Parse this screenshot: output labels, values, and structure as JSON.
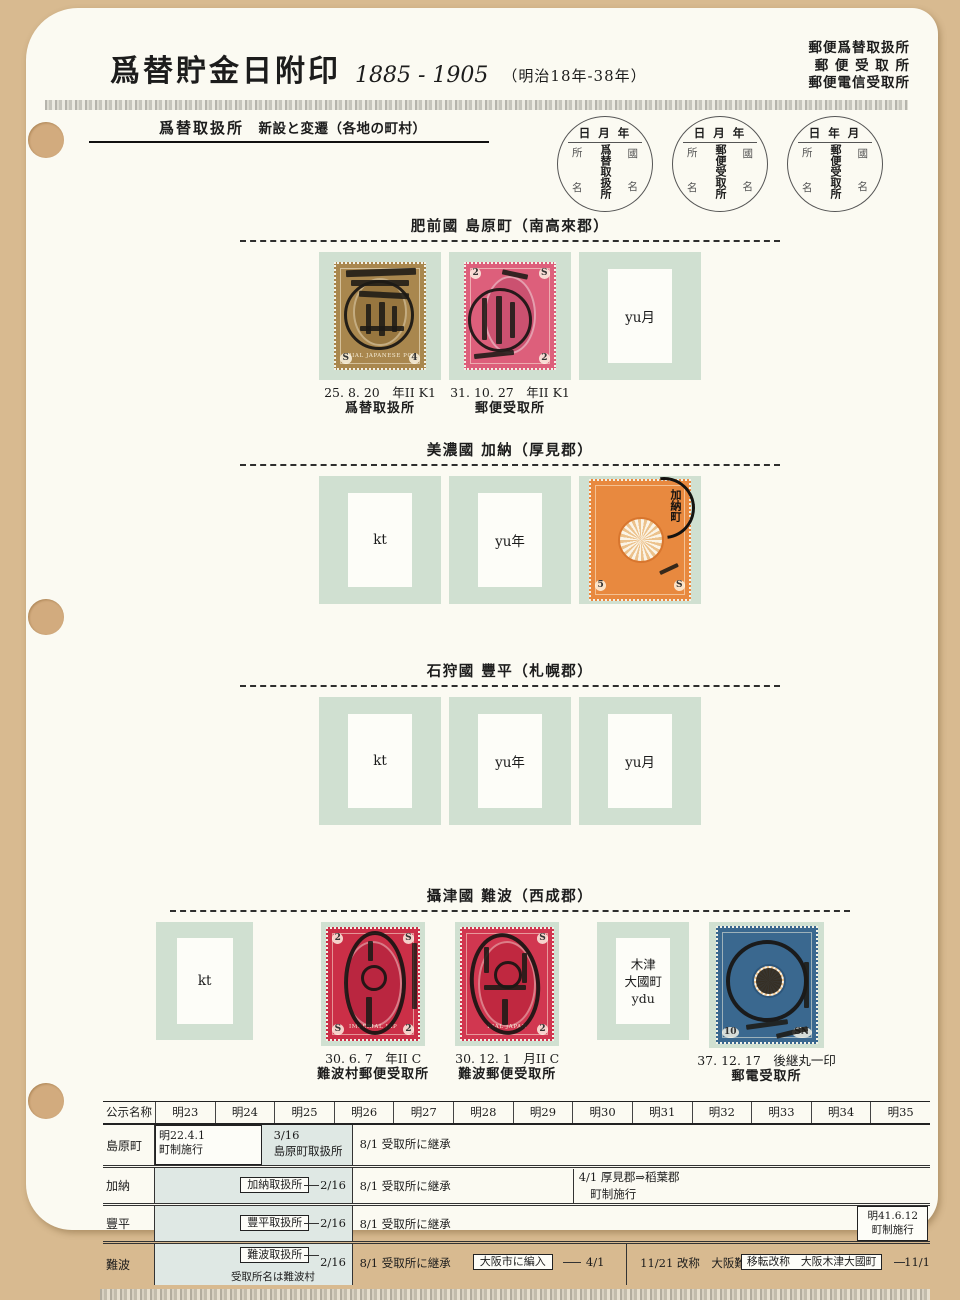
{
  "colors": {
    "backing_tan": "#d8ba90",
    "page_white": "#fbfaf2",
    "mount_green": "#d0e0d1",
    "stamp_olive": "#a9874e",
    "stamp_pink": "#dd5f7b",
    "stamp_red": "#cb2f47",
    "stamp_orange": "#e8893f",
    "stamp_blue": "#3a688f"
  },
  "header": {
    "title": "爲替貯金日附印",
    "years": "1885 - 1905",
    "era": "（明治18年-38年）",
    "corner_lines": [
      "郵便爲替取扱所",
      "郵 便 受 取 所",
      "郵便電信受取所"
    ],
    "subtitle": "爲替取扱所",
    "subtitle_note": "新設と変遷（各地の町村）"
  },
  "seals": [
    {
      "top": "日 月 年",
      "left_top": "所",
      "left_bottom": "名",
      "center": "爲替取扱所",
      "right_top": "國",
      "right_bottom": "名"
    },
    {
      "top": "日 月 年",
      "left_top": "所",
      "left_bottom": "名",
      "center": "郵便受取所",
      "right_top": "國",
      "right_bottom": "名"
    },
    {
      "top": "日 年 月",
      "left_top": "所",
      "left_bottom": "名",
      "center": "郵便受取所",
      "right_top": "國",
      "right_bottom": "名"
    }
  ],
  "sections": [
    {
      "title": "肥前國 島原町（南高來郡）",
      "slots": [
        {
          "caption1": "25. 8. 20　年II K1",
          "caption2": "爲替取扱所",
          "arc": "RIAL JAPANESE PO",
          "corner_bl": "S",
          "corner_br": "4"
        },
        {
          "caption1": "31. 10. 27　年II K1",
          "caption2": "郵便受取所",
          "corner_tl": "2",
          "corner_tr": "S",
          "corner_br": "2"
        },
        {
          "placeholder": "yu月"
        }
      ]
    },
    {
      "title": "美濃國 加納（厚見郡）",
      "slots": [
        {
          "placeholder": "kt"
        },
        {
          "placeholder": "yu年"
        },
        {
          "postmark": "加納町",
          "corner_bl": "5",
          "corner_br": "S"
        }
      ]
    },
    {
      "title": "石狩國 豐平（札幌郡）",
      "slots": [
        {
          "placeholder": "kt"
        },
        {
          "placeholder": "yu年"
        },
        {
          "placeholder": "yu月"
        }
      ]
    },
    {
      "title": "攝津國 難波（西成郡）",
      "slots": [
        {
          "placeholder": "kt"
        },
        {
          "caption1": "30. 6. 7　年II C",
          "caption2": "難波村郵便受取所",
          "arc": "IMPERIAL JAP",
          "corner_tl": "2",
          "corner_tr": "S",
          "corner_bl": "S",
          "corner_br": "2"
        },
        {
          "caption1": "30. 12. 1　月II C",
          "caption2": "難波郵便受取所",
          "arc": "RIAL JAPAN",
          "corner_tr": "S",
          "corner_br": "2"
        },
        {
          "placeholder": "木津\n大國町\nydu"
        },
        {
          "caption1": "37. 12. 17　後継丸一印",
          "caption2": "郵電受取所",
          "corner_bl": "10",
          "corner_br": "SN"
        }
      ]
    }
  ],
  "table": {
    "header": [
      "公示名称",
      "明23",
      "明24",
      "明25",
      "明26",
      "明27",
      "明28",
      "明29",
      "明30",
      "明31",
      "明32",
      "明33",
      "明34",
      "明35"
    ],
    "rows": {
      "shimabara": {
        "name": "島原町",
        "box": "明22.4.1\n町制施行",
        "note": "3/16\n島原町取扱所",
        "inherit": "8/1 受取所に継承"
      },
      "kano": {
        "name": "加納",
        "box": "加納取扱所",
        "date": "2/16",
        "inherit": "8/1 受取所に継承",
        "event": "4/1 厚見郡⇒稻葉郡\n　町制施行"
      },
      "toyohira": {
        "name": "豐平",
        "box": "豐平取扱所",
        "date": "2/16",
        "inherit": "8/1 受取所に継承",
        "later": "明41.6.12\n町制施行"
      },
      "namba": {
        "name": "難波",
        "box": "難波取扱所",
        "box_note": "受取所名は難波村",
        "date": "2/16",
        "inherit": "8/1 受取所に継承",
        "box2": "大阪市に編入",
        "date2": "4/1",
        "event": "11/21 改称　大阪難波",
        "box3": "移転改称　大阪木津大國町",
        "date3": "11/1"
      }
    }
  }
}
